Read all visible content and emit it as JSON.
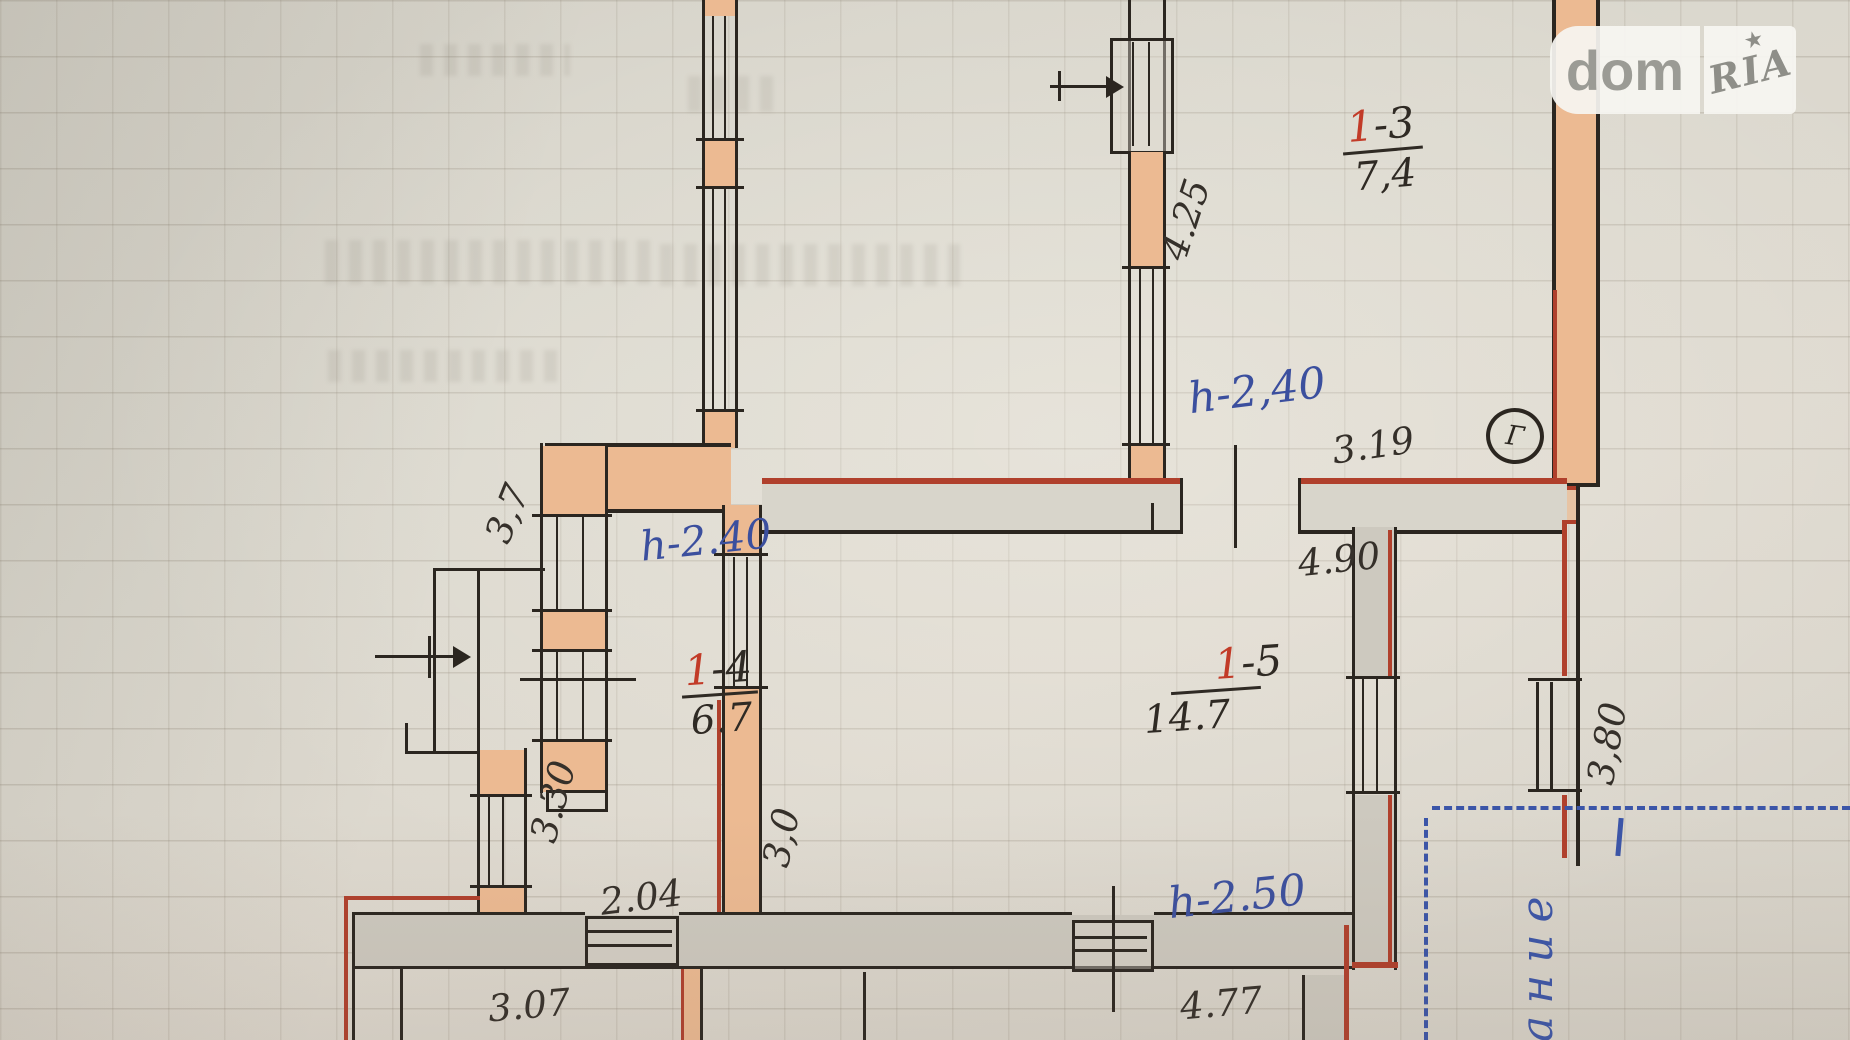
{
  "watermark": {
    "brand_left": "dom",
    "brand_right": "RIA",
    "star": "★"
  },
  "plan": {
    "rooms": [
      {
        "key": "room-1-3",
        "num_red": "1",
        "num_black": "-3",
        "area": "7,4"
      },
      {
        "key": "room-1-4",
        "num_red": "1",
        "num_black": "-4",
        "area": "6.7"
      },
      {
        "key": "room-1-5",
        "num_red": "1",
        "num_black": "-5",
        "area": "14.7"
      }
    ],
    "heights": {
      "top_room": "h-2,40",
      "room_1_4": "h-2.40",
      "room_1_5": "h-2.50"
    },
    "dims": {
      "d425": "4.25",
      "d319": "3.19",
      "d37": "3,7",
      "d330": "3.30",
      "d204": "2.04",
      "d30": "3,0",
      "d490": "4.90",
      "d380": "3,80",
      "d307": "3.07",
      "d477": "4.77"
    },
    "marks": {
      "section_letter": "Г",
      "side_word": "ание"
    }
  }
}
